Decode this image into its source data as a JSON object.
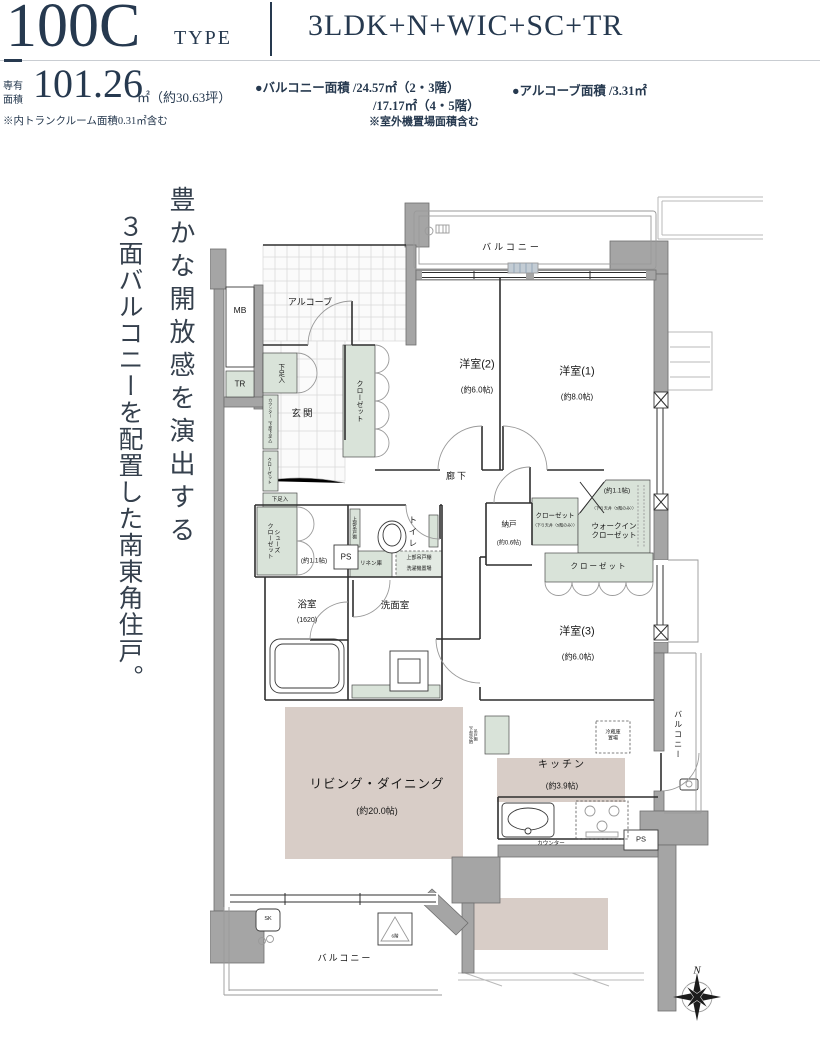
{
  "header": {
    "type_code": "100C",
    "type_word": "TYPE",
    "layout": "3LDK+N+WIC+SC+TR"
  },
  "specs": {
    "area_label_1": "専有",
    "area_label_2": "面積",
    "area_value": "101.26",
    "area_unit": "㎡（約30.63坪）",
    "area_note": "※内トランクルーム面積0.31㎡含む",
    "balcony_label": "●バルコニー面積 /24.57㎡（2・3階）",
    "balcony_line2": "/17.17㎡（4・5階）",
    "balcony_note": "※室外機置場面積含む",
    "alcove_label": "●アルコーブ面積 /3.31㎡"
  },
  "tagline": {
    "line1": "豊かな開放感を演出する",
    "line2": "３面バルコニーを配置した南東角住戸。"
  },
  "plan": {
    "balcony_top": "バルコニー",
    "mb": "MB",
    "tr": "TR",
    "alcove": "アルコーブ",
    "shoe1": "下足入",
    "counter_note": "カウンター（下部下足入）",
    "closet_genkan": "クローゼット",
    "genkan": "玄関",
    "shoe2": "下足入",
    "closet_y2": "クローゼット",
    "y2": "洋室(2)",
    "y2_size": "(約6.0帖)",
    "y1": "洋室(1)",
    "y1_size": "(約8.0帖)",
    "rouka": "廊下",
    "sc_1": "シューズ",
    "sc_2": "クローゼット",
    "sc_size": "(約1.1帖)",
    "ps1": "PS",
    "upper_cab1": "上部吊戸棚",
    "toilet": "トイレ",
    "linen": "リネン庫",
    "upper_cab2": "上部吊戸棚",
    "washer": "洗濯機置場",
    "bath": "浴室",
    "bath_size": "(1620)",
    "senmen": "洗面室",
    "nando": "納戸",
    "nando_size": "(約0.6帖)",
    "closet_n": "クローゼット",
    "closet_n_note": "（下り天井（5階のみ））",
    "wic_size": "(約1.1帖)",
    "wic_note": "（下り天井（5階のみ））",
    "wic_1": "ウォークイン",
    "wic_2": "クローゼット",
    "closet_y3": "クローゼット",
    "y3": "洋室(3)",
    "y3_size": "(約6.0帖)",
    "hang_cab_1": "吊戸棚",
    "hang_cab_2": "（下部収納）",
    "fridge_1": "冷蔵庫",
    "fridge_2": "置場",
    "ld": "リビング・ダイニング",
    "ld_size": "(約20.0帖)",
    "kitchen": "キッチン",
    "kitchen_size": "(約3.9帖)",
    "counter": "カウンター",
    "ps2": "PS",
    "balcony_right": "バルコニー",
    "sk": "SK",
    "hatch": "6階",
    "balcony_bottom": "バルコニー",
    "compass_n": "N"
  },
  "colors": {
    "navy": "#26394f",
    "wall_gray": "#a5a5a5",
    "storage_green": "#d9e3d9",
    "room_pink": "#d8cdc7"
  }
}
